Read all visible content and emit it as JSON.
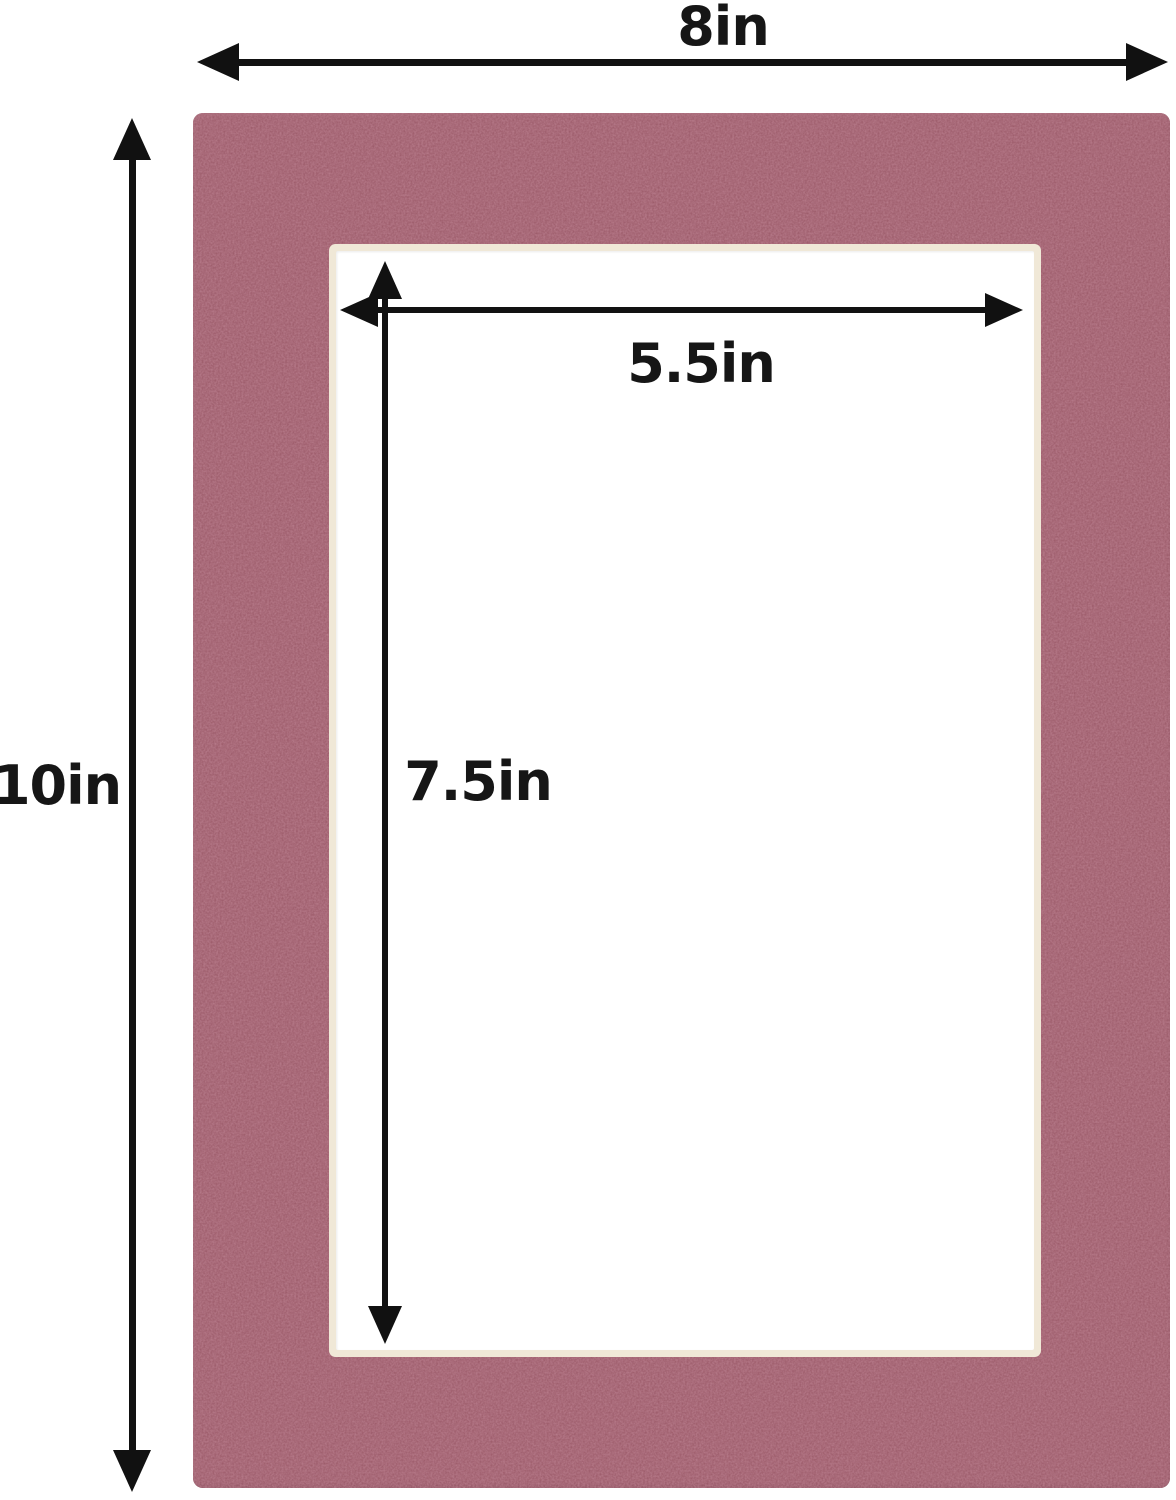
{
  "diagram": {
    "description": "Dimension diagram of a burgundy picture-frame mat board with a rectangular cut-out opening",
    "colors": {
      "mat": "#7d3644",
      "bevel": "#f0e8d7",
      "opening": "#ffffff",
      "arrow": "#111111",
      "background": "#ffffff",
      "label_text": "#161616"
    },
    "labels": {
      "outer_width": "8in",
      "outer_height": "10in",
      "opening_width": "5.5in",
      "opening_height": "7.5in"
    }
  }
}
